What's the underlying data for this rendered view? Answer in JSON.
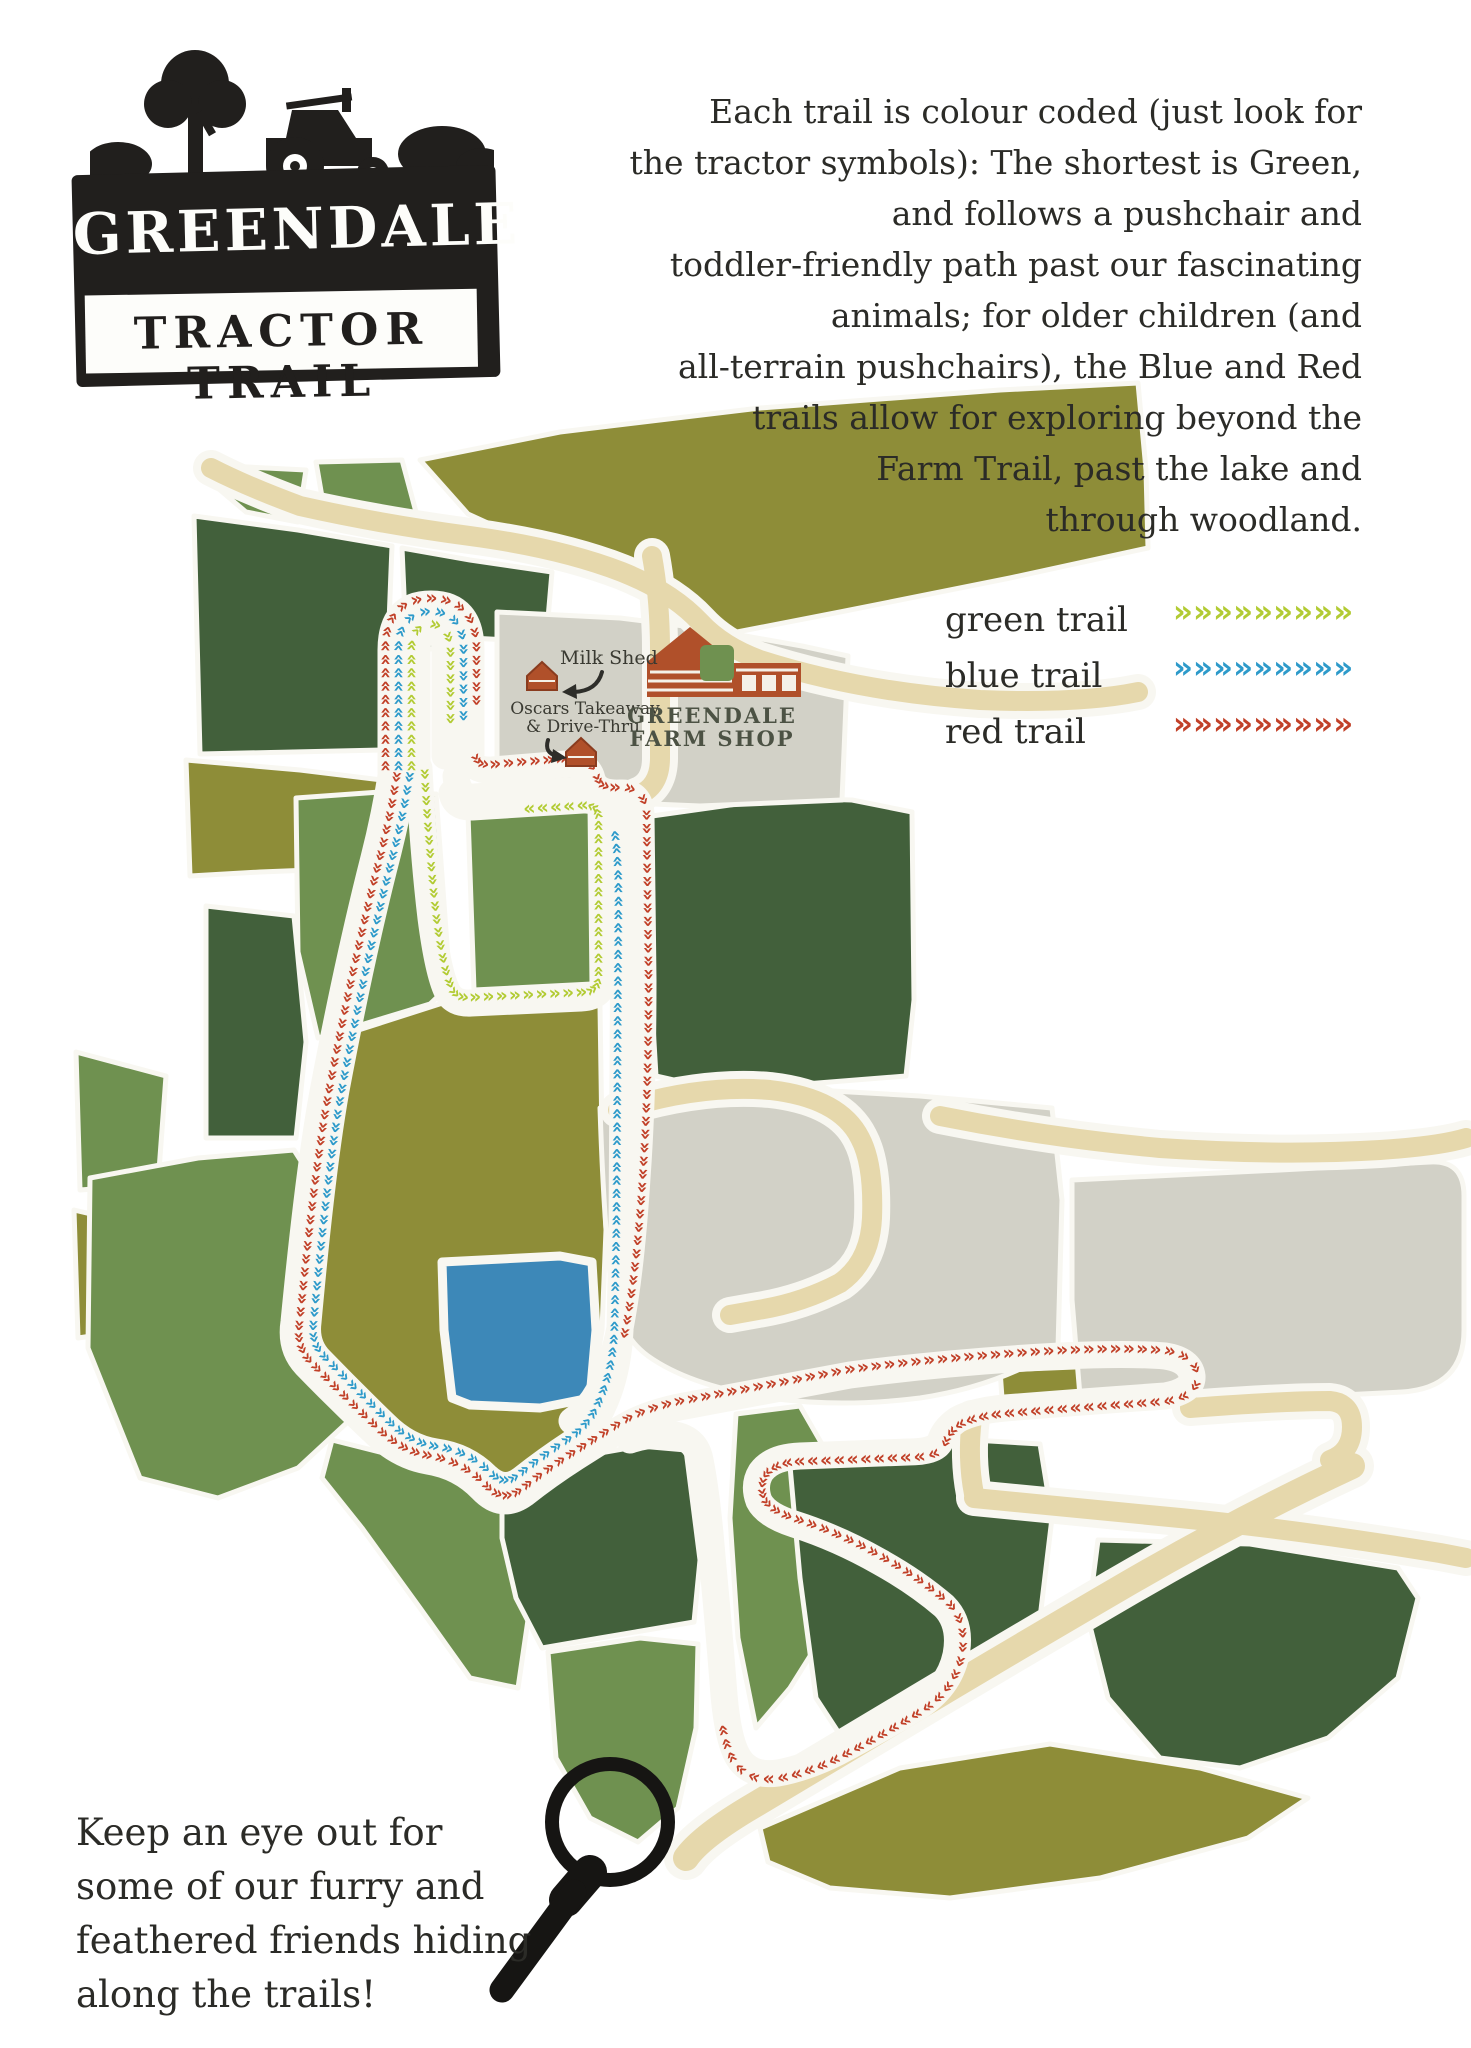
{
  "logo": {
    "title": "GREENDALE",
    "subtitle": "TRACTOR TRAIL"
  },
  "intro": {
    "text": "Each trail is colour coded (just look for\nthe tractor symbols): The shortest is Green,\nand follows a pushchair and\ntoddler-friendly path past our fascinating\nanimals; for older children (and\nall-terrain pushchairs), the Blue and Red\ntrails allow for exploring beyond the\nFarm Trail, past the lake and\nthrough woodland."
  },
  "legend": {
    "chevron": "»",
    "items": [
      {
        "label": "green trail",
        "color": "#b2cb33"
      },
      {
        "label": "blue trail",
        "color": "#2d9aca"
      },
      {
        "label": "red trail",
        "color": "#c14028"
      }
    ]
  },
  "map": {
    "labels": {
      "milk_shed": "Milk Shed",
      "oscars_line1": "Oscars Takeaway",
      "oscars_line2": "& Drive-Thru",
      "farm_shop_line1": "GREENDALE",
      "farm_shop_line2": "FARM SHOP"
    }
  },
  "footer": {
    "text": "Keep an eye out for\nsome of our furry and\nfeathered friends hiding\nalong the trails!"
  },
  "theme": {
    "ink": "#211f1d",
    "dark": "#42603b",
    "med": "#6f9150",
    "olive": "#8e8d38",
    "tan": "#e6d8ac",
    "grey": "#d2d1c7",
    "pond": "#3d88b8",
    "lime": "#b2cb33",
    "blue": "#2d9aca",
    "red": "#c14028"
  }
}
